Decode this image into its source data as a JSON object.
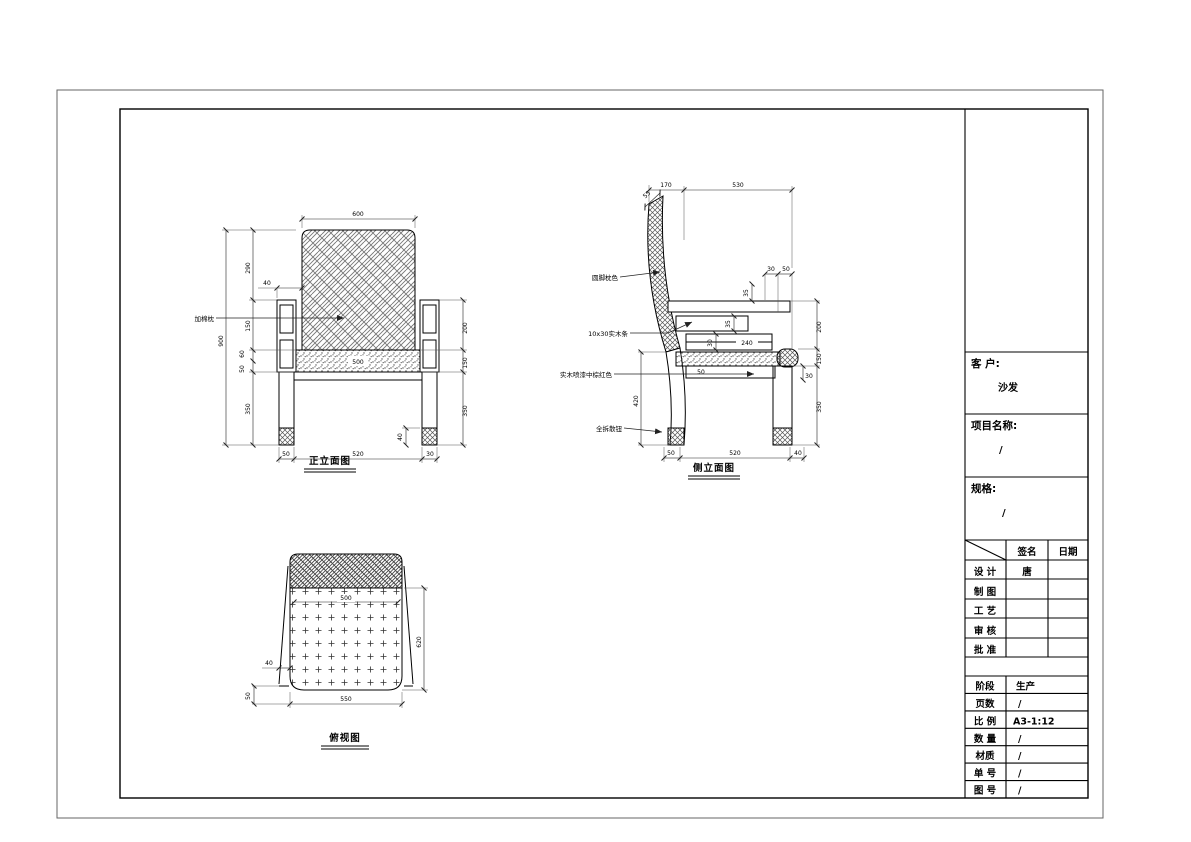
{
  "sheet": {
    "background": "#ffffff",
    "line": "#000000"
  },
  "front_view": {
    "title": "正立面图",
    "back_label": "加棉枕",
    "dims": {
      "top_width": "600",
      "overall_height": "900",
      "back_height": "290",
      "arm_to_seat": "150",
      "cushion_thick": "60",
      "seat_rail": "50",
      "leg_height": "350",
      "arm_offset": "40",
      "seat_width": "500",
      "arm_height_right": "200",
      "seat_section_right": "150",
      "leg_right": "350",
      "bottom_left": "50",
      "bottom_center": "520",
      "bottom_right": "30",
      "foot_height": "40"
    }
  },
  "side_view": {
    "title": "侧立面图",
    "labels": {
      "back_cushion": "圆脚枕色",
      "wood_strip": "10x30实木条",
      "leg_finish": "实木喷漆中棕红色",
      "hardware": "全拆散钮"
    },
    "dims": {
      "top_back": "170",
      "top_seat": "530",
      "back_thickness": "55",
      "gap_a": "30",
      "gap_b": "50",
      "arm_rail": "35",
      "frame_a": "35",
      "frame_b": "30",
      "inner_width": "240",
      "apron": "50",
      "leg_inset": "30",
      "arm_height": "200",
      "seat_section": "150",
      "leg_height": "350",
      "seat_to_floor": "420",
      "bottom_left": "50",
      "bottom_center": "520",
      "bottom_right": "40"
    }
  },
  "top_view": {
    "title": "俯视图",
    "dims": {
      "seat_width": "500",
      "seat_depth": "620",
      "bottom_width": "550",
      "arm_width": "40",
      "edge_offset": "50"
    }
  },
  "title_block": {
    "customer_label": "客 户:",
    "customer_value": "沙发",
    "project_label": "项目名称:",
    "project_value": "/",
    "spec_label": "规格:",
    "spec_value": "/",
    "sign_table": {
      "sign_col": "签名",
      "date_col": "日期",
      "rows": [
        {
          "label": "设 计",
          "sign": "唐",
          "date": ""
        },
        {
          "label": "制 图",
          "sign": "",
          "date": ""
        },
        {
          "label": "工 艺",
          "sign": "",
          "date": ""
        },
        {
          "label": "审 核",
          "sign": "",
          "date": ""
        },
        {
          "label": "批 准",
          "sign": "",
          "date": ""
        }
      ]
    },
    "info_rows": [
      {
        "label": "阶段",
        "value": "生产"
      },
      {
        "label": "页数",
        "value": "/"
      },
      {
        "label": "比 例",
        "value": "A3-1:12"
      },
      {
        "label": "数 量",
        "value": "/"
      },
      {
        "label": "材质",
        "value": "/"
      },
      {
        "label": "单 号",
        "value": "/"
      },
      {
        "label": "图 号",
        "value": "/"
      }
    ]
  }
}
